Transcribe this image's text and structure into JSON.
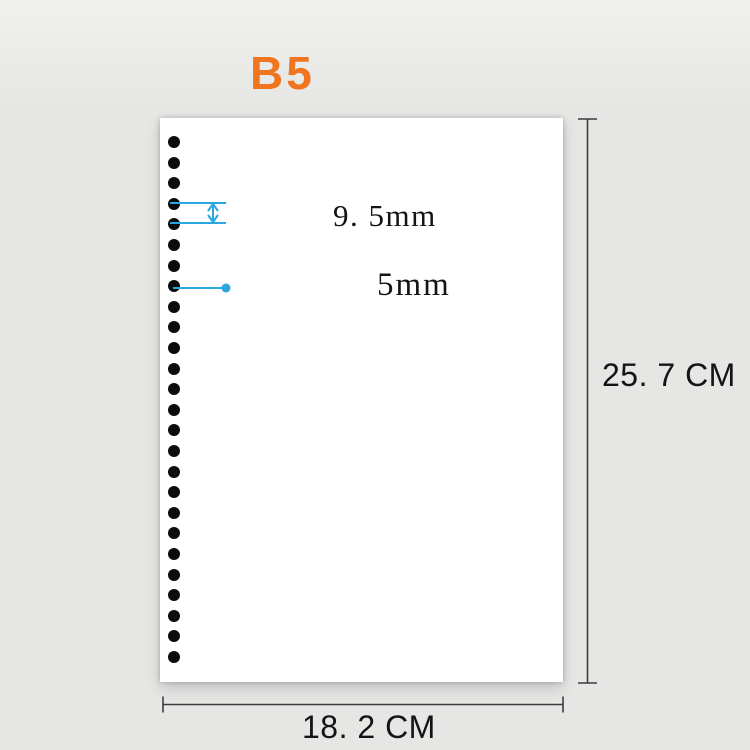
{
  "title": {
    "label": "B5"
  },
  "paper": {
    "hole_count": 26,
    "annotations": {
      "hole_spacing_label": "9. 5mm",
      "hole_diameter_label": "5mm"
    }
  },
  "dimensions": {
    "height_label": "25. 7 CM",
    "width_label": "18. 2 CM"
  },
  "colors": {
    "accent_orange": "#ef7520",
    "annotation_blue": "#2aa7df",
    "dimension_line": "#3c3c3c",
    "text": "#141414",
    "background": "#e6e7e5",
    "paper": "#ffffff",
    "hole": "#0c0c0c"
  }
}
